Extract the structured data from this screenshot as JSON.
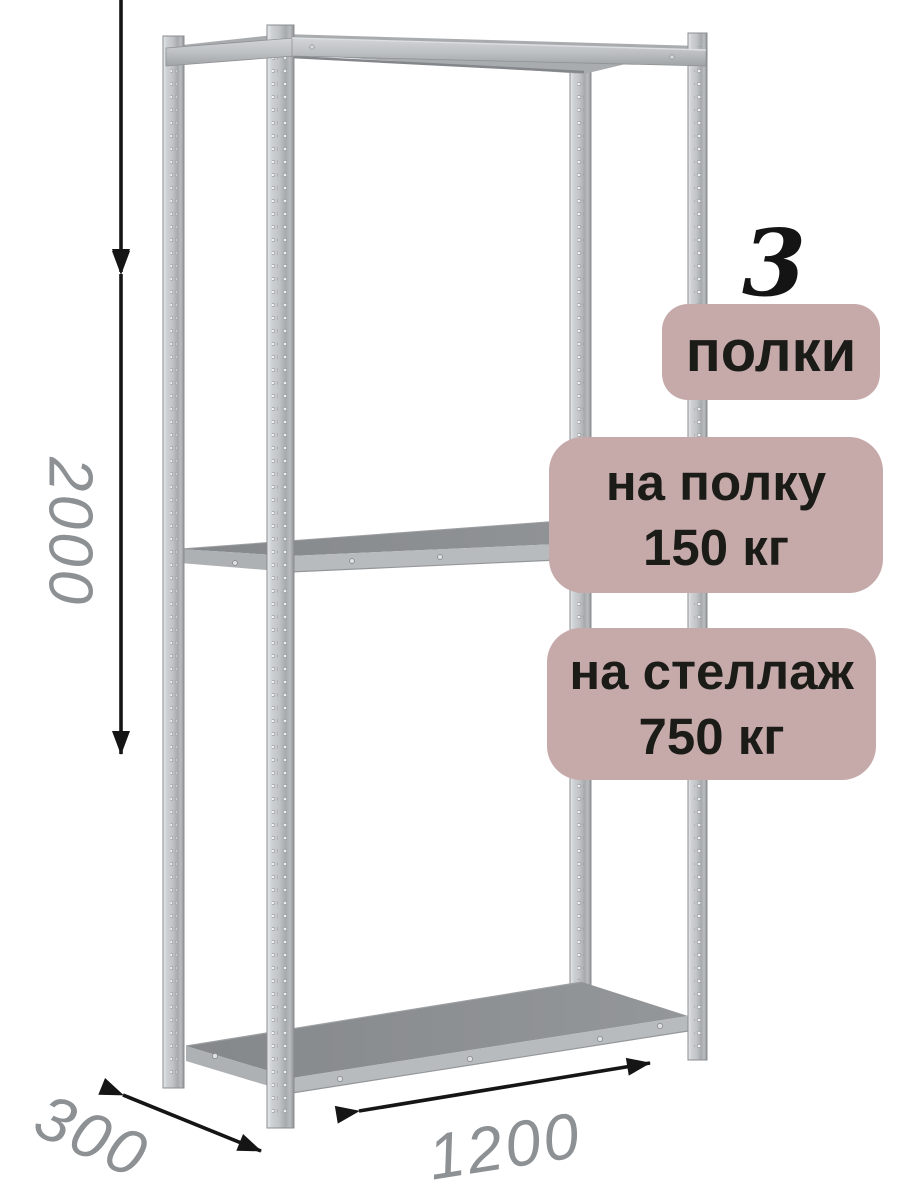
{
  "annotations": {
    "shelf_count": "3",
    "shelf_count_label": "полки",
    "shelf_load": {
      "line1": "на полку",
      "line2": "150 кг"
    },
    "rack_load": {
      "line1": "на стеллаж",
      "line2": "750 кг"
    }
  },
  "dimensions": {
    "height": "2000",
    "depth": "300",
    "width": "1200"
  },
  "colors": {
    "badge_bg": "#c6aaaa",
    "badge_text": "#1b1b18",
    "dimension_text": "#8d9194",
    "arrow": "#151515",
    "metal_light": "#cdd0d2",
    "metal_mid": "#b4b7ba",
    "metal_dark": "#8c8f92",
    "background": "#ffffff"
  }
}
